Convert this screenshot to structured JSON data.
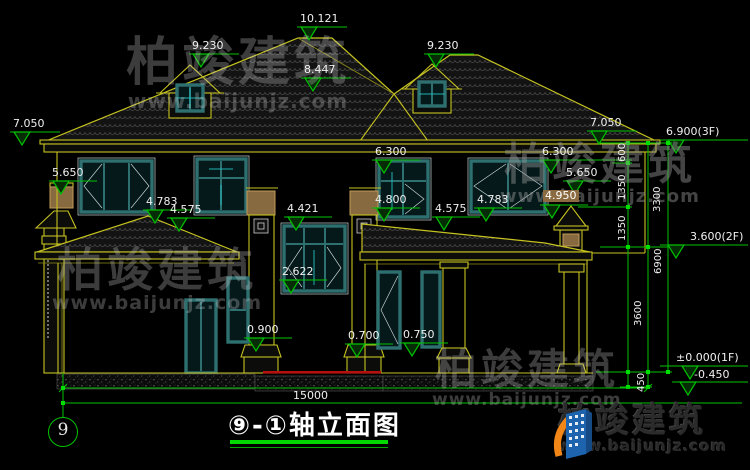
{
  "drawing": {
    "type": "architectural-elevation",
    "sheet_background": "#000000",
    "colors": {
      "line_yellow": "#c6c320",
      "dim_green": "#00c300",
      "title_underline_green": "#00d800",
      "window_teal": "#2e7070",
      "accent_tan": "#8a6a40",
      "threshold_red": "#b51010",
      "text_white": "#f0f0f0"
    }
  },
  "title": {
    "name": "⑨-①轴立面图",
    "axis": "9"
  },
  "labels": {
    "ridge": "10.121",
    "dormer": "9.230",
    "valley": "8.447",
    "eave": "7.050",
    "level_3f": "6.900(3F)",
    "win_head_2f": "6.300",
    "level_5650": "5.650",
    "win_sill_48": "4.800",
    "porch_ridge": "4.783",
    "porch_eave": "4.575",
    "label_495": "4.950",
    "cwin_head": "4.421",
    "cwin_sill": "2.622",
    "sill_09": "0.900",
    "sill_07": "0.700",
    "sill_075": "0.750",
    "level_1f": "±0.000(1F)",
    "level_minus": "-0.450",
    "level_2f": "3.600(2F)",
    "total_width": "15000",
    "chain": {
      "c600": "600",
      "c1350": "1350",
      "c3300": "3300",
      "c3600": "3600",
      "c450": "450",
      "c6900": "6900"
    }
  },
  "brand": {
    "cn": "柏竣建筑",
    "url": "www.baijunjz.com"
  }
}
